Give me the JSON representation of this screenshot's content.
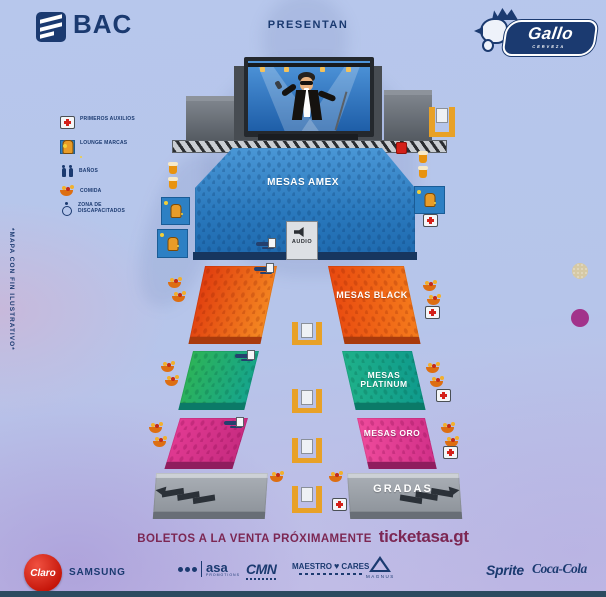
{
  "header": {
    "bac": "BAC",
    "presentan": "PRESENTAN",
    "gallo": "Gallo",
    "gallo_sub": "CERVEZA"
  },
  "legend": {
    "items": [
      {
        "icon": "first-aid-icon",
        "label": "PRIMEROS AUXILIOS"
      },
      {
        "icon": "lounge-icon",
        "label": "LOUNGE MARCAS"
      },
      {
        "icon": "restroom-icon",
        "label": "BAÑOS"
      },
      {
        "icon": "food-icon",
        "label": "COMIDA"
      },
      {
        "icon": "wheelchair-icon",
        "label": "ZONA DE DISCAPACITADOS"
      }
    ]
  },
  "note_vertical": "*MAPA CON FIN ILUSTRATIVO*",
  "stage": {
    "audio": "AUDIO"
  },
  "sections": {
    "amex": {
      "label": "MESAS AMEX",
      "color": "#2f86c9"
    },
    "black": {
      "label": "MESAS BLACK",
      "color": "#f26b1c"
    },
    "platinum": {
      "label": "MESAS PLATINUM",
      "color": "#1fae8e"
    },
    "oro": {
      "label": "MESAS ORO",
      "color": "#de3a92"
    },
    "gradas": {
      "label": "GRADAS",
      "color": "#9aa1a8"
    }
  },
  "footer": {
    "tickets_text": "BOLETOS A LA VENTA PRÓXIMAMENTE",
    "tickets_site": "ticketasa.gt",
    "sponsors": {
      "claro": "Claro",
      "samsung": "SAMSUNG",
      "asa": "asa",
      "asa_sub": "PROMOTIONS",
      "cmn": "CMN",
      "maestro": "MAESTRO",
      "heart": "♥",
      "cares": "CARES",
      "magnus": "MAGNUS",
      "sprite": "Sprite",
      "cocacola": "Coca-Cola"
    }
  }
}
